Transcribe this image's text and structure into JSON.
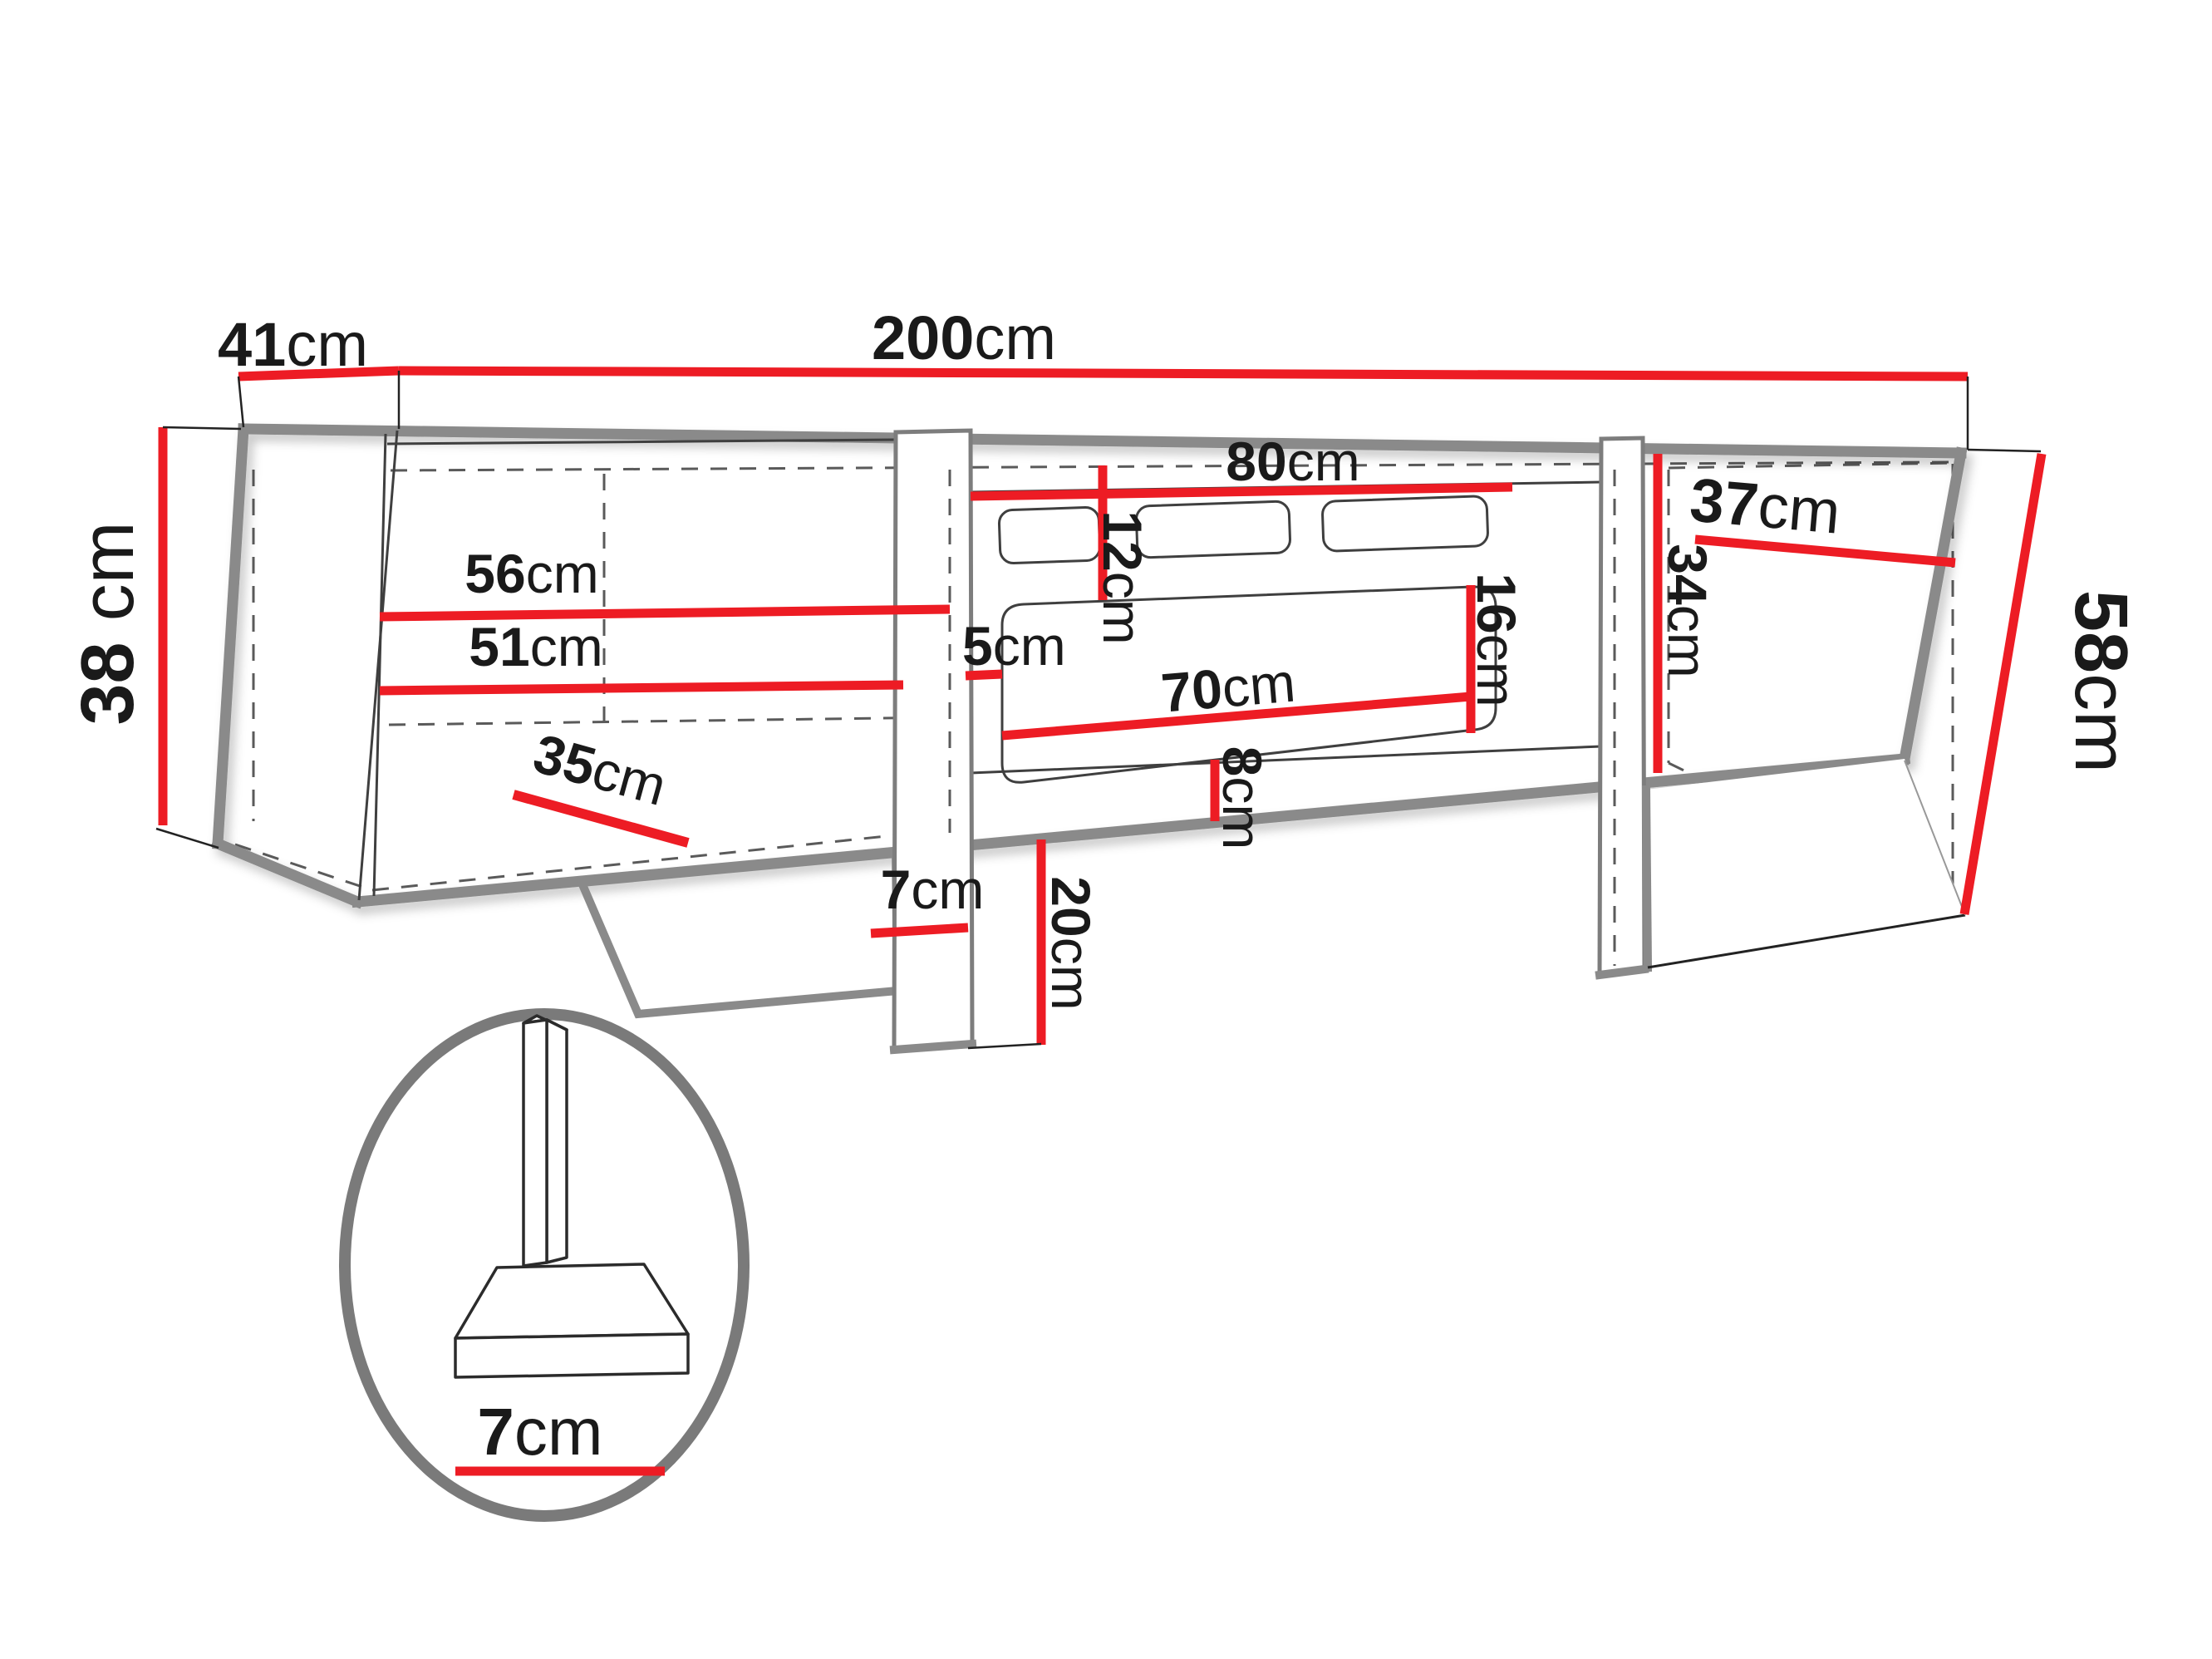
{
  "page": {
    "title": "TV cabinet dimension diagram",
    "background": "#ffffff"
  },
  "colors": {
    "dimension_line": "#ed1c24",
    "outline_thick": "#8a8a8a",
    "outline_thin": "#3f3f3f",
    "dashed_line": "#5a5a5a",
    "label_text": "#1a1a1a"
  },
  "labels": {
    "depth": {
      "value": "41",
      "unit": "cm"
    },
    "total_width": {
      "value": "200",
      "unit": "cm"
    },
    "body_height": {
      "value": "38",
      "unit": " cm"
    },
    "left_shelf_top": {
      "value": "56",
      "unit": "cm"
    },
    "left_shelf_bottom": {
      "value": "51",
      "unit": "cm"
    },
    "left_bottom_depth": {
      "value": "35",
      "unit": "cm"
    },
    "fireplace_width": {
      "value": "80",
      "unit": "cm"
    },
    "vent_height": {
      "value": "12",
      "unit": "cm"
    },
    "gap_left_of_glass": {
      "value": "5",
      "unit": "cm"
    },
    "glass_width": {
      "value": "70",
      "unit": "cm"
    },
    "glass_height": {
      "value": "16",
      "unit": "cm"
    },
    "below_glass": {
      "value": "8",
      "unit": "cm"
    },
    "right_shelf_depth": {
      "value": "37",
      "unit": "cm"
    },
    "right_opening_height": {
      "value": "34",
      "unit": "cm"
    },
    "total_height": {
      "value": "58",
      "unit": "cm"
    },
    "leg_front_width": {
      "value": "7",
      "unit": "cm"
    },
    "leg_height": {
      "value": "20",
      "unit": "cm"
    },
    "leg_detail_width": {
      "value": "7",
      "unit": "cm"
    }
  }
}
